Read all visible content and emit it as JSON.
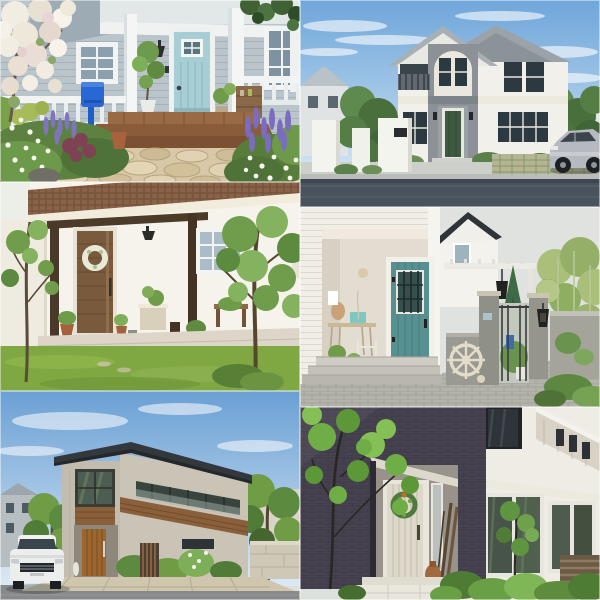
{
  "page": {
    "name": "house-exterior-photo-collage",
    "grid": {
      "columns": 2,
      "rows": 3,
      "tile_count": 6
    },
    "canvas": {
      "width": 600,
      "height": 600
    }
  },
  "tiles": [
    {
      "id": "porch-teal-door",
      "grid_position": "row-1-col-1",
      "alt": "Light blue-gray sided porch with pale teal front door, white posts and railing, bright blue mailbox, wooden deck steps, flagstone path, lavender and white flowers",
      "palette": {
        "siding": "#b9c4cb",
        "trim": "#f2f4f3",
        "door": "#a7cdd5",
        "mailbox": "#2968d4",
        "deck": "#96653f",
        "flagstone": "#dbcba9",
        "lavender": "#7f74bd",
        "foliage": "#6d9a4b"
      }
    },
    {
      "id": "two-story-gabled-house",
      "grid_position": "row-1-col-2",
      "alt": "White two-story double-gabled house with gray accent tower, arched entry detail, dark green front door, white gate piers, hedges, silver sedan and asphalt street under blue sky",
      "palette": {
        "sky": "#78aadc",
        "wall": "#f1f0ea",
        "accent": "#8b9196",
        "roof": "#9ba3a8",
        "door": "#3f5a43",
        "road": "#4a535d",
        "car": "#b6bac0"
      }
    },
    {
      "id": "wood-door-porch-lawn",
      "grid_position": "row-2-col-1",
      "alt": "White single-story house with brown shingle roof, dark timber porch posts and beam, walnut wood front door with white wreath, gridded window, potted plants and green lawn with slender trees",
      "palette": {
        "wall": "#f6f3ec",
        "roof": "#8a6248",
        "timber": "#4a3828",
        "door": "#7a5a3d",
        "lawn": "#7fa742",
        "window_pane": "#a9bcc8"
      }
    },
    {
      "id": "coastal-entry-gate",
      "grid_position": "row-2-col-2",
      "alt": "White lap-siding entry with teal door and black iron grille, concrete steps, paver driveway, mottled concrete gate piers with coach lantern, white pergola, conifer, ship's wheel and starfish decor under gray sky",
      "palette": {
        "siding": "#f1eee7",
        "door": "#579090",
        "concrete": "#94948b",
        "pavers": "#b3b2ab",
        "gable_roof": "#2f3439",
        "conifer": "#3f6a45",
        "sky": "#e0e2df"
      }
    },
    {
      "id": "modern-street-house",
      "grid_position": "row-3-col-1",
      "alt": "Modern two-story house with dark low-pitch roof, beige stone walls, timber accent bands, tall reflective windows, glass balcony, wooden front door, white sedan parked on the street, trees and blue sky",
      "palette": {
        "sky": "#74a6d6",
        "roof": "#33383c",
        "wall": "#c6c0b2",
        "timber": "#8a5f3b",
        "car": "#eceeee",
        "road": "#87898a",
        "pavers": "#cfc6ad"
      }
    },
    {
      "id": "dark-brick-entry",
      "grid_position": "row-3-col-2",
      "alt": "Charcoal-purple brick facade with recessed entry, whitewashed plank door with green wreath and orange bow, vintage skis and terracotta jug, white stone step, bright greenery and a white modern house with glass walls beyond",
      "palette": {
        "brick": "#474250",
        "door": "#ddd8ca",
        "wreath": "#4e7a3c",
        "step": "#e9e6dd",
        "neighbor_wall": "#efece5",
        "foliage": "#69a046"
      }
    }
  ]
}
